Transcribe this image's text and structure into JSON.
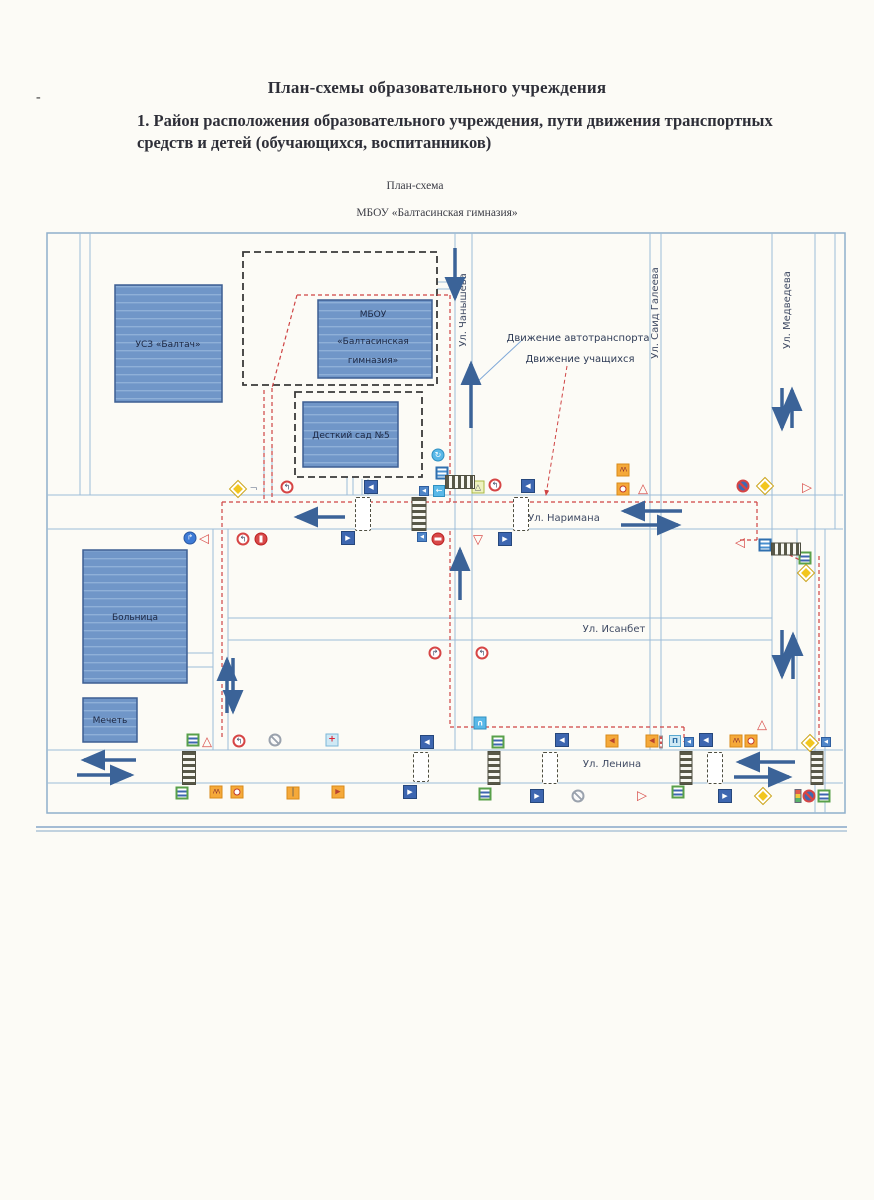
{
  "page": {
    "title": "План-схемы образовательного учреждения",
    "section_heading": "1. Район расположения образовательного учреждения, пути движения транспортных средств и детей (обучающихся, воспитанников)",
    "scheme_caption": "План-схема",
    "school_caption": "МБОУ «Балтасинская гимназия»",
    "margin_dash": "-"
  },
  "legend": {
    "auto_label": "Движение автотранспорта",
    "students_label": "Движение учащихся"
  },
  "map": {
    "buildings": {
      "usz": {
        "label": "УСЗ «Балтач»"
      },
      "gym": {
        "line1": "МБОУ",
        "line2": "«Балтасинская",
        "line3": "гимназия»"
      },
      "kindergarten": {
        "label": "Десткий сад №5"
      },
      "hospital": {
        "label": "Больница"
      },
      "mosque": {
        "label": "Мечеть"
      }
    },
    "streets": {
      "chanysheva": "Ул. Чанышева",
      "said_galeeva": "Ул. Саид Галеева",
      "medvedeva": "Ул. Медведева",
      "narimana": "Ул. Наримана",
      "isanbet": "Ул. Исанбет",
      "lenina": "Ул. Ленина"
    },
    "signs": [
      {
        "t": "main-road",
        "x": 238,
        "y": 489
      },
      {
        "t": "road-fork",
        "x": 254,
        "y": 489
      },
      {
        "t": "no-left-turn",
        "x": 287,
        "y": 487
      },
      {
        "t": "blue-left",
        "x": 371,
        "y": 487
      },
      {
        "t": "roundabout",
        "x": 438,
        "y": 455
      },
      {
        "t": "crosswalk-blue",
        "x": 442,
        "y": 473
      },
      {
        "t": "blue-left-sm",
        "x": 424,
        "y": 491
      },
      {
        "t": "cyan-left",
        "x": 439,
        "y": 491
      },
      {
        "t": "ped-warning",
        "x": 478,
        "y": 487
      },
      {
        "t": "no-left-turn",
        "x": 495,
        "y": 485
      },
      {
        "t": "blue-left",
        "x": 528,
        "y": 486
      },
      {
        "t": "children",
        "x": 623,
        "y": 470
      },
      {
        "t": "bus-stop",
        "x": 623,
        "y": 489
      },
      {
        "t": "warning-tri",
        "x": 643,
        "y": 489
      },
      {
        "t": "no-stopping",
        "x": 743,
        "y": 486
      },
      {
        "t": "main-road",
        "x": 765,
        "y": 486
      },
      {
        "t": "tri-right",
        "x": 807,
        "y": 488
      },
      {
        "t": "turn-blue",
        "x": 190,
        "y": 538
      },
      {
        "t": "tri-left",
        "x": 204,
        "y": 539
      },
      {
        "t": "no-left-turn",
        "x": 243,
        "y": 539
      },
      {
        "t": "prohibit",
        "x": 261,
        "y": 539
      },
      {
        "t": "blue-right",
        "x": 348,
        "y": 538
      },
      {
        "t": "blue-left-sm",
        "x": 422,
        "y": 537
      },
      {
        "t": "no-entry",
        "x": 438,
        "y": 539
      },
      {
        "t": "yield",
        "x": 478,
        "y": 540
      },
      {
        "t": "blue-right",
        "x": 505,
        "y": 539
      },
      {
        "t": "tri-left",
        "x": 740,
        "y": 543
      },
      {
        "t": "crosswalk-blue",
        "x": 765,
        "y": 545
      },
      {
        "t": "ped-green",
        "x": 805,
        "y": 558
      },
      {
        "t": "main-road",
        "x": 806,
        "y": 573
      },
      {
        "t": "no-right-turn",
        "x": 435,
        "y": 653
      },
      {
        "t": "no-left-turn",
        "x": 482,
        "y": 653
      },
      {
        "t": "u-turn",
        "x": 480,
        "y": 723
      },
      {
        "t": "warning-tri",
        "x": 762,
        "y": 725
      },
      {
        "t": "ped-green",
        "x": 193,
        "y": 740
      },
      {
        "t": "warning-tri",
        "x": 207,
        "y": 742
      },
      {
        "t": "no-left-turn",
        "x": 239,
        "y": 741
      },
      {
        "t": "no-parking",
        "x": 275,
        "y": 740
      },
      {
        "t": "hospital",
        "x": 332,
        "y": 740
      },
      {
        "t": "blue-left",
        "x": 427,
        "y": 742
      },
      {
        "t": "ped-green",
        "x": 498,
        "y": 742
      },
      {
        "t": "blue-left",
        "x": 562,
        "y": 740
      },
      {
        "t": "orange-left",
        "x": 612,
        "y": 741
      },
      {
        "t": "orange-left",
        "x": 652,
        "y": 741
      },
      {
        "t": "pole",
        "x": 661,
        "y": 742
      },
      {
        "t": "bus-stop-blue",
        "x": 675,
        "y": 741
      },
      {
        "t": "blue-left-sm",
        "x": 689,
        "y": 742
      },
      {
        "t": "blue-left",
        "x": 706,
        "y": 740
      },
      {
        "t": "children",
        "x": 736,
        "y": 741
      },
      {
        "t": "bus-stop",
        "x": 751,
        "y": 741
      },
      {
        "t": "main-road",
        "x": 810,
        "y": 743
      },
      {
        "t": "blue-left-sm",
        "x": 826,
        "y": 742
      },
      {
        "t": "ped-green",
        "x": 182,
        "y": 793
      },
      {
        "t": "children",
        "x": 216,
        "y": 792
      },
      {
        "t": "bus-stop",
        "x": 237,
        "y": 792
      },
      {
        "t": "orange-pole",
        "x": 293,
        "y": 793
      },
      {
        "t": "orange-right",
        "x": 338,
        "y": 792
      },
      {
        "t": "blue-right",
        "x": 410,
        "y": 792
      },
      {
        "t": "ped-green",
        "x": 485,
        "y": 794
      },
      {
        "t": "blue-right",
        "x": 537,
        "y": 796
      },
      {
        "t": "no-parking",
        "x": 578,
        "y": 796
      },
      {
        "t": "tri-right",
        "x": 642,
        "y": 796
      },
      {
        "t": "ped-green",
        "x": 678,
        "y": 792
      },
      {
        "t": "blue-right",
        "x": 725,
        "y": 796
      },
      {
        "t": "main-road",
        "x": 763,
        "y": 796
      },
      {
        "t": "traffic-light",
        "x": 798,
        "y": 796
      },
      {
        "t": "no-stopping",
        "x": 809,
        "y": 796
      },
      {
        "t": "ped-green",
        "x": 824,
        "y": 796
      }
    ],
    "zebras": [
      {
        "o": "h",
        "x": 460,
        "y": 482,
        "w": 30,
        "h": 14
      },
      {
        "o": "h",
        "x": 786,
        "y": 549,
        "w": 30,
        "h": 13
      },
      {
        "o": "v",
        "x": 419,
        "y": 514,
        "w": 15,
        "h": 34
      },
      {
        "o": "v",
        "x": 189,
        "y": 768,
        "w": 14,
        "h": 34
      },
      {
        "o": "v",
        "x": 494,
        "y": 768,
        "w": 13,
        "h": 34
      },
      {
        "o": "v",
        "x": 686,
        "y": 768,
        "w": 13,
        "h": 34
      },
      {
        "o": "v",
        "x": 817,
        "y": 768,
        "w": 13,
        "h": 34
      }
    ],
    "bumps": [
      {
        "x": 363,
        "y": 514,
        "w": 16,
        "h": 34
      },
      {
        "x": 521,
        "y": 514,
        "w": 16,
        "h": 34
      },
      {
        "x": 421,
        "y": 767,
        "w": 16,
        "h": 30
      },
      {
        "x": 550,
        "y": 768,
        "w": 16,
        "h": 32
      },
      {
        "x": 715,
        "y": 768,
        "w": 16,
        "h": 32
      }
    ]
  },
  "colors": {
    "building_fill": "#7096c8",
    "building_border": "#3d5e92",
    "street_line": "#9dbdd8",
    "traffic_arrow": "#3b6398",
    "student_path": "#cf4444",
    "boundary_dash": "#3a3a3a",
    "main_road_yellow": "#f2c61e",
    "sign_blue": "#3d66b0",
    "sign_orange": "#f5a93a",
    "sign_red": "#d64545",
    "sign_cyan": "#59b8e8"
  }
}
